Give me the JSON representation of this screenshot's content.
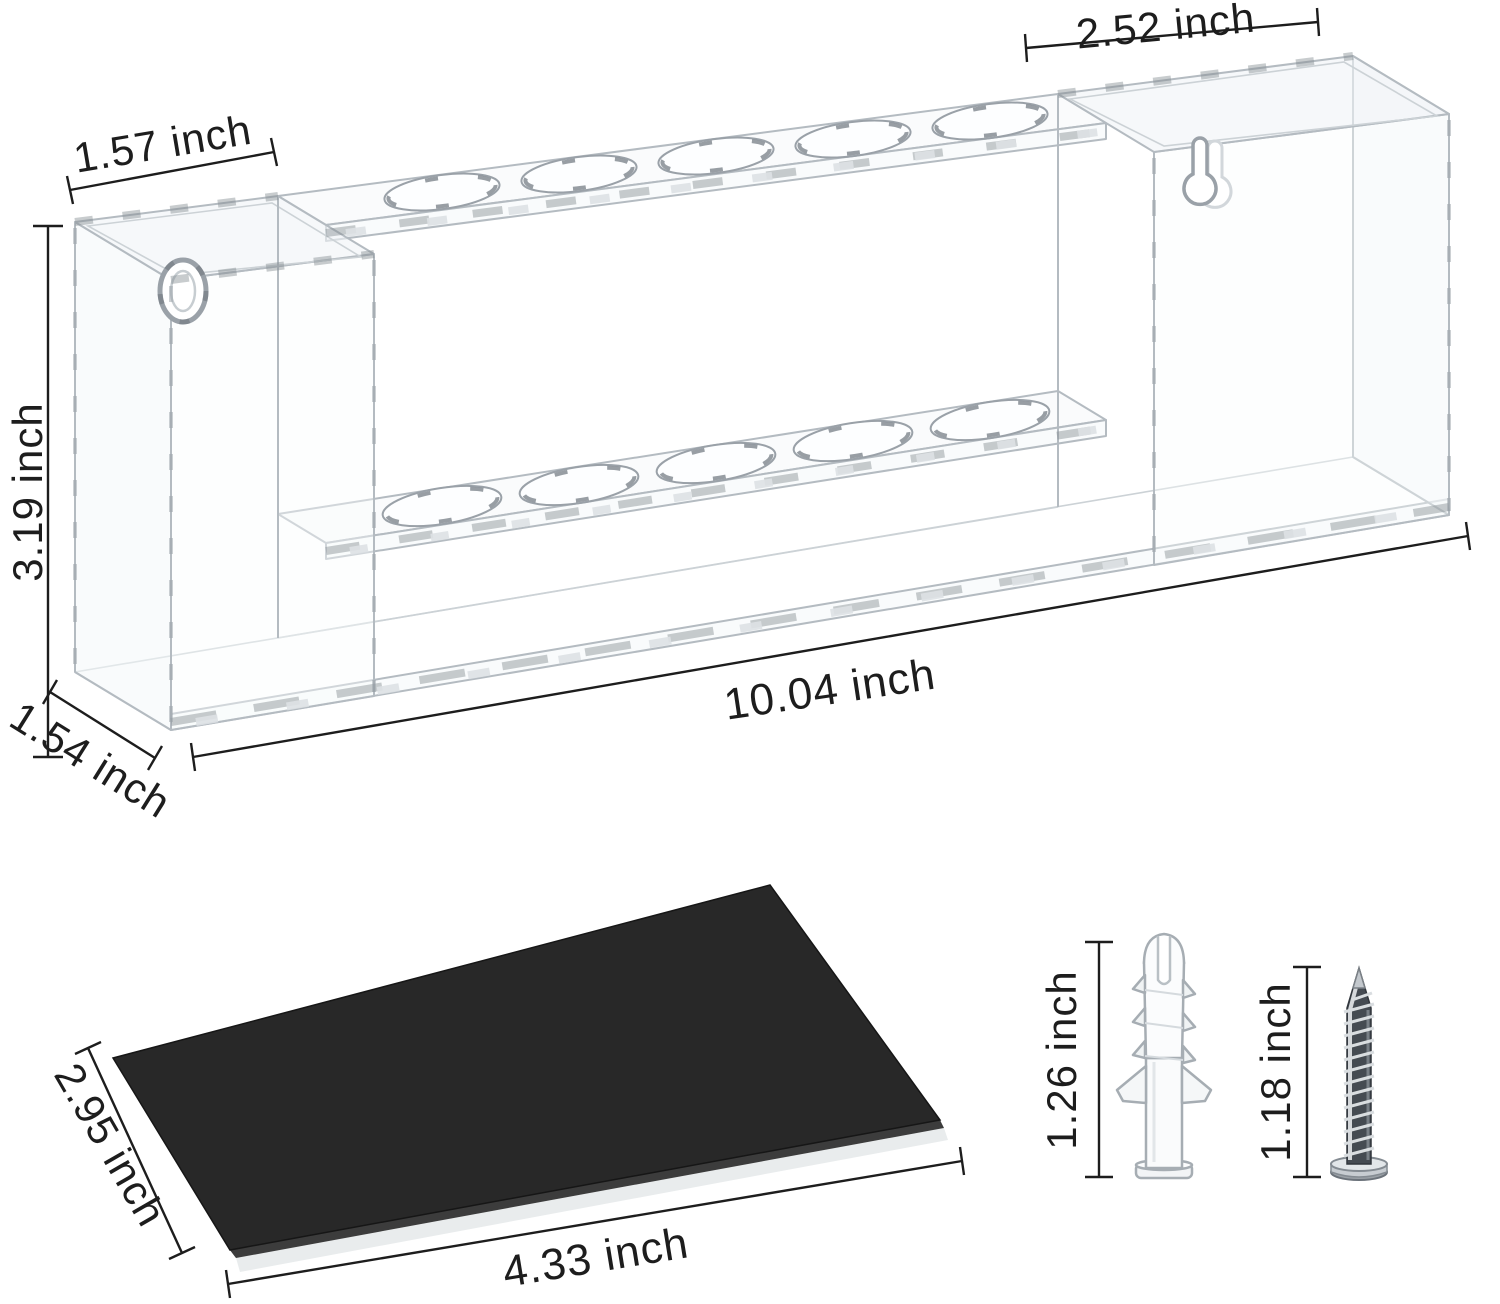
{
  "page": {
    "background": "#ffffff",
    "type": "product dimension diagram"
  },
  "colors": {
    "dimension_lines": "#1d1d1d",
    "acrylic_outline": "#b4bbc1",
    "shimmer": "#868d93",
    "sheet": "#282828"
  },
  "holder": {
    "description": "clear acrylic two-tier wall-mount holder with keyhole slots",
    "rows_of_holes": 2,
    "holes_per_row": 5,
    "keyholes": 2,
    "dimensions": {
      "left_section_width": "1.57 inch",
      "right_section_width": "2.52 inch",
      "height": "3.19 inch",
      "depth": "1.54 inch",
      "overall_length": "10.04 inch"
    }
  },
  "adhesive_sheet": {
    "color": "#282828",
    "width": "2.95 inch",
    "length": "4.33 inch"
  },
  "wall_anchor": {
    "length": "1.26 inch"
  },
  "screw": {
    "length": "1.18 inch"
  }
}
